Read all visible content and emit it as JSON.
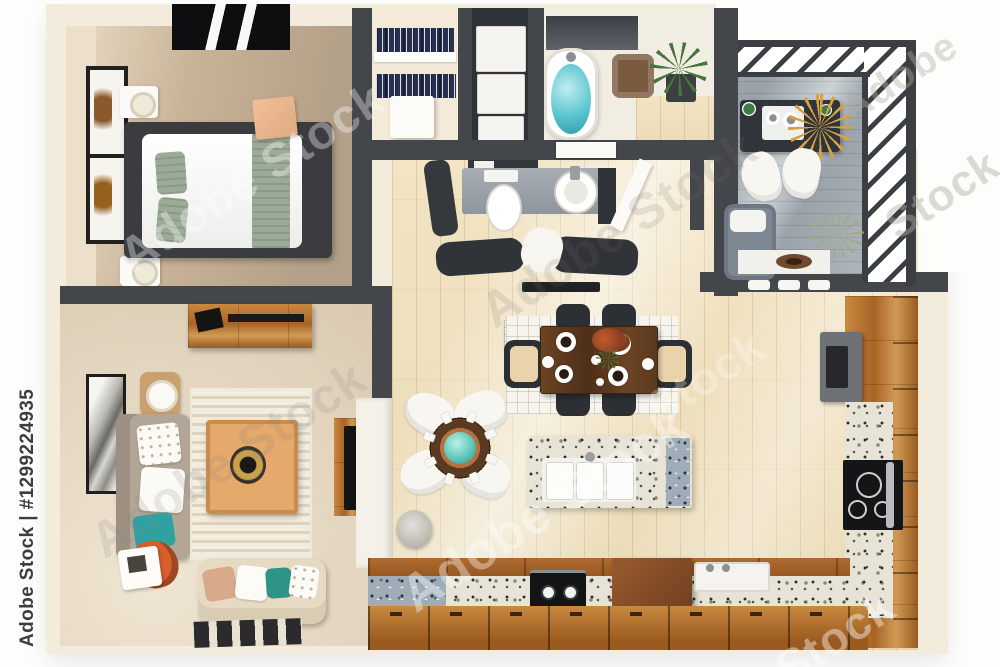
{
  "watermark": {
    "full_label": "Adobe Stock | #1299224935",
    "brand": "Adobe Stock",
    "word": "Stock",
    "word2": "Adobe"
  },
  "palette": {
    "background": "#ffffff",
    "slab_cream": "#f3ecdc",
    "wall_dark": "#43464b",
    "wood_cabinet": "#b5742f",
    "floor_pale": "#f0e2c0",
    "bedroom_tan": "#c6b196",
    "granite_light": "#e7e3d6",
    "granite_blue": "#9fadb8",
    "teal_accent": "#58c4cf",
    "sage_green": "#9cab97",
    "orange_accent": "#d65f2c",
    "navy_clothes": "#27304e",
    "deck_gray": "#a9b2b8",
    "watermark_text": "#3d3d3d"
  }
}
